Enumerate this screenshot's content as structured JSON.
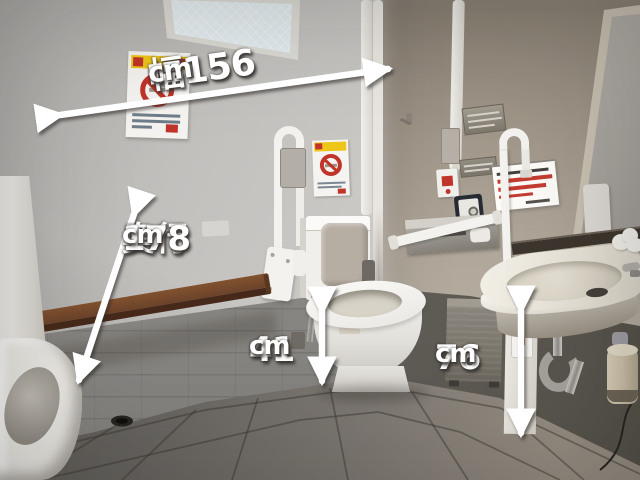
{
  "annotations": {
    "width": {
      "value": "幅156",
      "unit": "cm"
    },
    "depth": {
      "label": "奥行",
      "value": "178",
      "unit": "cm"
    },
    "toilet_seat_height": {
      "value": "41",
      "unit": "cm"
    },
    "sink_height": {
      "value": "76",
      "unit": "cm"
    }
  },
  "colors": {
    "annotation_text": "#ffffff",
    "annotation_shadow": "#3a3633",
    "arrow": "#ffffff",
    "left_wall": "#c4c2bf",
    "right_wall": "#ac9f8f",
    "wainscot": "#8f8d89",
    "floor_dark": "#58554f",
    "floor_light": "#988f84",
    "bench_wood": "#6b432a",
    "fixture_white": "#f3f2ee",
    "poster_yellow": "#eec61a",
    "prohibition_red": "#c0342a",
    "notice_red": "#c43c32",
    "steel": "#a5a29c"
  }
}
